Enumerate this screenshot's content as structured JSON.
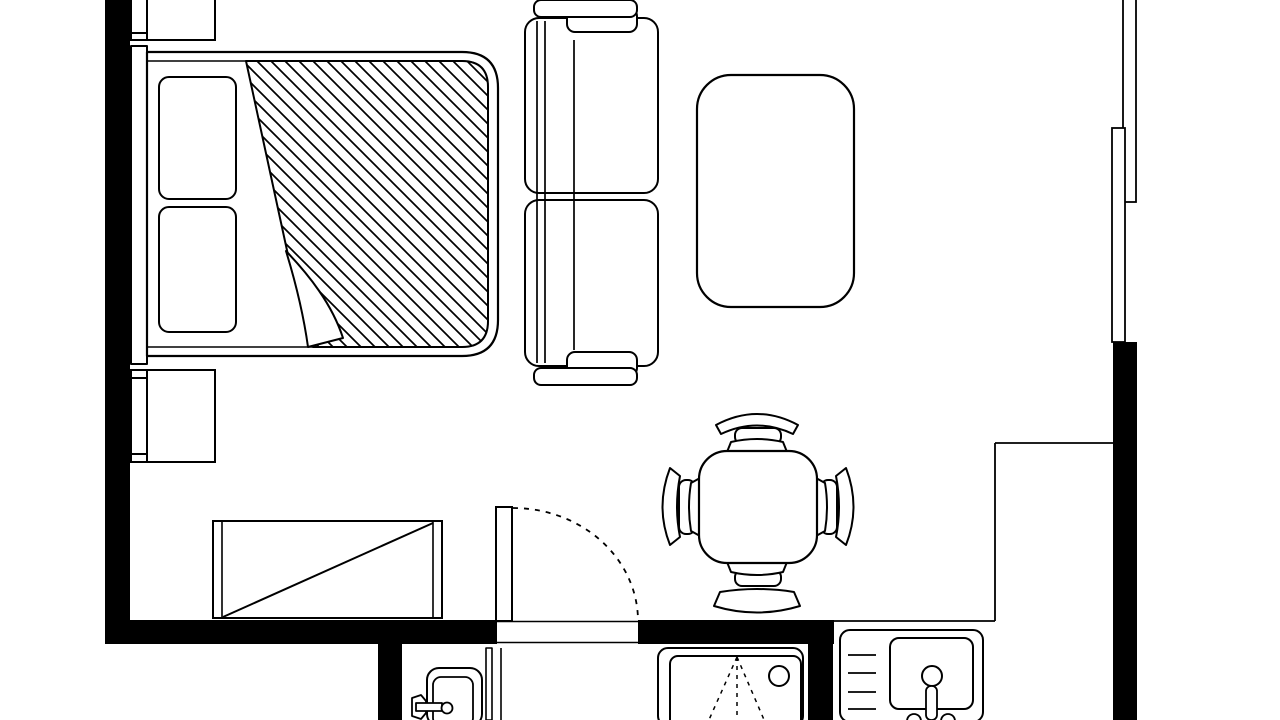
{
  "meta": {
    "type": "architectural floor plan",
    "style": "monochrome line drawing, top-down view",
    "title": "Studio apartment floor plan"
  },
  "colors": {
    "background": "#ffffff",
    "line": "#000000",
    "wall_fill": "#000000"
  },
  "pattern": {
    "duvet_hatch_angle_deg": 45,
    "duvet_hatch_spacing_px": 14
  },
  "items": {
    "walls": {
      "label": "Thick black walls with entry opening at bottom"
    },
    "window_upper": {
      "label": "Window strip, right wall upper"
    },
    "window_lower": {
      "label": "Window strip, right wall lower"
    },
    "counter": {
      "label": "Kitchen counter edge lines"
    },
    "bed": {
      "label": "Double bed with hatched duvet and folded-back corner"
    },
    "pillow_top": {
      "label": "Pillow"
    },
    "pillow_bottom": {
      "label": "Pillow"
    },
    "nightstand_top": {
      "label": "Nightstand above bed"
    },
    "nightstand_bottom": {
      "label": "Nightstand below bed"
    },
    "sofa": {
      "label": "Two-seat sofa facing right"
    },
    "rug": {
      "label": "Rug / coffee table, rounded rectangle"
    },
    "dining_table": {
      "label": "Square dining table with rounded corners"
    },
    "chair_top": {
      "label": "Dining chair, top"
    },
    "chair_bottom": {
      "label": "Dining chair, bottom"
    },
    "chair_left": {
      "label": "Dining chair, left"
    },
    "chair_right": {
      "label": "Dining chair, right"
    },
    "dresser": {
      "label": "Dresser / sideboard with crossed diagonal"
    },
    "door": {
      "label": "Entry door leaf with dashed swing arc"
    },
    "bathtub": {
      "label": "Bathtub with faucet, bottom left of bathroom"
    },
    "partition": {
      "label": "Bathroom partition / door track"
    },
    "shower": {
      "label": "Shower stall with dashed drain triangle"
    },
    "kitchen_sink": {
      "label": "Kitchen sink with drainboard and faucet"
    }
  }
}
